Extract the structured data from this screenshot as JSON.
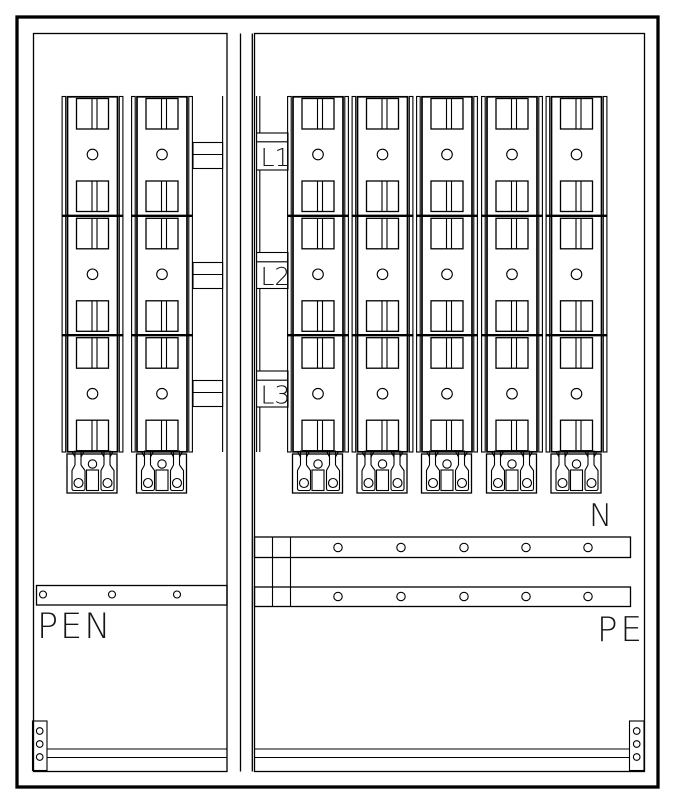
{
  "labels": {
    "phase_l1": "L1",
    "phase_l2": "L2",
    "phase_l3": "L3",
    "pen_bus": "PEN",
    "neutral_bus": "N",
    "pe_bus": "PE"
  },
  "structure": {
    "drawing_type": "electrical-distribution-cabinet-layout",
    "left_panel": {
      "fuse_strips": 2,
      "phase_connector_bands": 3,
      "pen_busbar_holes": 3,
      "corner_terminal_holes": 3
    },
    "right_panel": {
      "fuse_strips": 5,
      "phase_label_boxes": [
        "L1",
        "L2",
        "L3"
      ],
      "neutral_busbar_holes": 5,
      "pe_busbar_holes": 5,
      "corner_terminal_holes": 3
    },
    "fuse_strip": {
      "sections_per_strip": 3,
      "handles_per_section": 2,
      "indicator_circles_per_strip": 3,
      "bottom_terminal_lugs": 2
    }
  },
  "colors": {
    "line": "#000000",
    "background": "#ffffff",
    "text": "#161616"
  }
}
